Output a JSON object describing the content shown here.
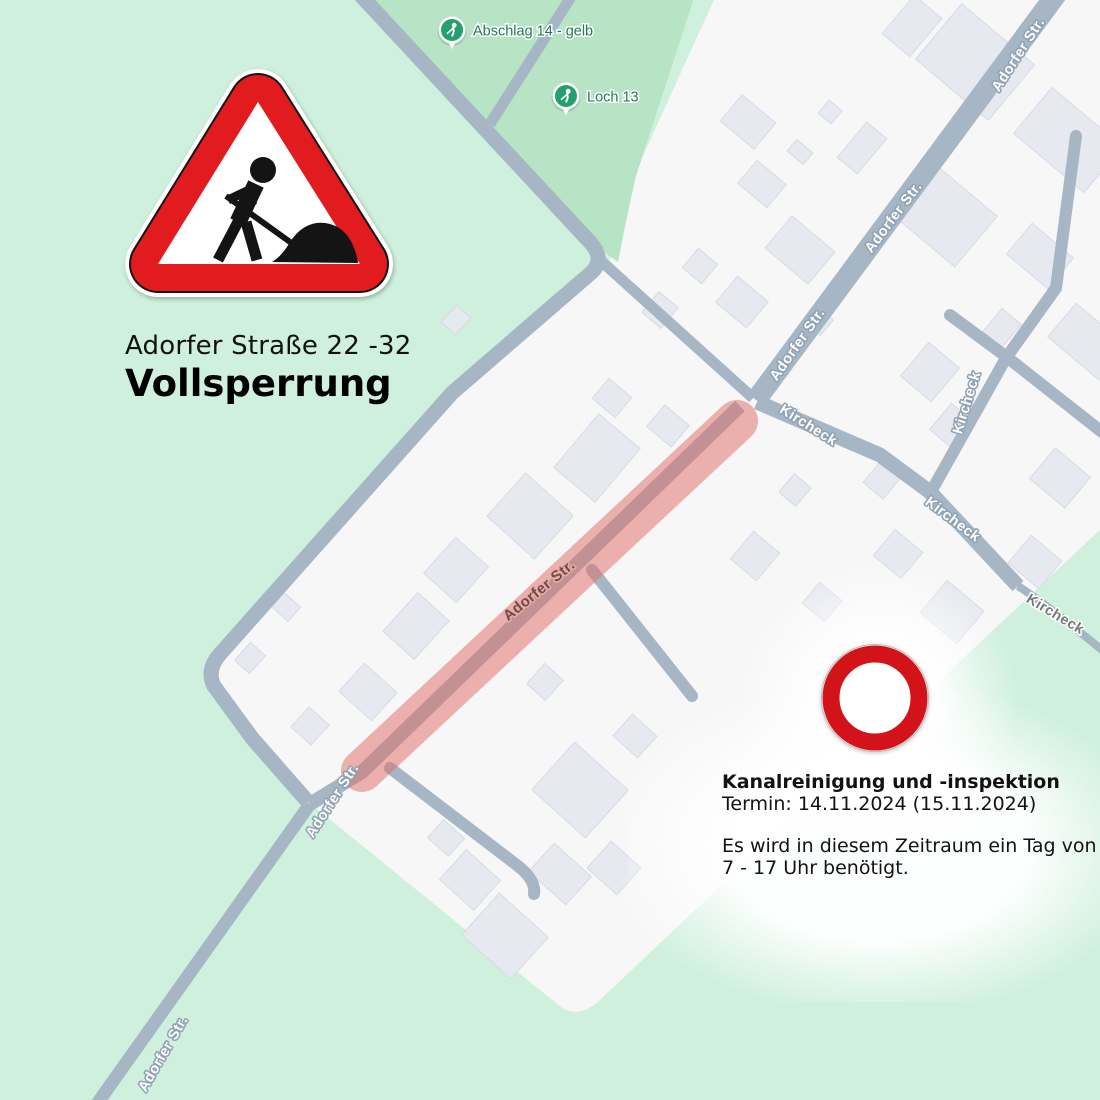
{
  "annotations": {
    "street_range": "Adorfer Straße 22 -32",
    "closure_type": "Vollsperrung",
    "info_title": "Kanalreinigung und -inspektion",
    "info_date": "Termin: 14.11.2024 (15.11.2024)",
    "info_body_1": "Es wird in diesem Zeitraum ein Tag von",
    "info_body_2": "7 - 17 Uhr benötigt."
  },
  "icons": {
    "roadworks": "roadworks-triangle-icon",
    "no_vehicles": "no-vehicles-circle-icon",
    "golf_marker": "golf-flag-marker-icon"
  },
  "signs": {
    "roadworks_red": "#e21b1f",
    "no_vehicles_red": "#d2141a"
  },
  "map": {
    "colors": {
      "meadow": "#cff0dd",
      "golf": "#b8e4c6",
      "urban": "#f7f7f8",
      "road": "#a6b6c5",
      "building": "#e6e9ef",
      "building_border": "#d6dbe4",
      "marker": "#23a06e",
      "marker_text": "#207a54",
      "closure": "#e06a62"
    },
    "regions": {
      "urban": "M723,-20 L632,180 Q620,228 612,256 L598,276 L452,393 L218,656 Q202,674 210,690 L306,800 L556,1003 Q576,1022 600,1000 C700,905 900,718 1104,526 L1104,-20 Z",
      "golf": "M352,-20 L588,238 L612,258 L618,262 Q626,220 636,176 L700,-20 Z"
    },
    "roads": [
      {
        "d": "M352,-14 L588,240 Q606,258 592,272 L452,393 L220,654 Q206,670 214,686 L252,738 L308,802",
        "w": 15
      },
      {
        "d": "M578,-14 L490,124",
        "w": 11
      },
      {
        "d": "M600,260 L753,398",
        "w": 11
      },
      {
        "d": "M1064,-16 L756,400",
        "w": 21
      },
      {
        "d": "M757,402 L880,455 L930,492 L1018,586",
        "w": 15
      },
      {
        "d": "M1018,586 Q1046,604 1102,650",
        "w": 8
      },
      {
        "d": "M1076,136 L1056,288 L1006,358 L932,490",
        "w": 12,
        "cap": "round"
      },
      {
        "d": "M950,315 L1008,358 L1102,432",
        "w": 12,
        "cap": "round"
      },
      {
        "d": "M740,406 L362,772 L310,804",
        "w": 14
      },
      {
        "d": "M310,804 L94,1108",
        "w": 13
      },
      {
        "d": "M390,768 L518,866 Q536,880 534,894",
        "w": 12,
        "cap": "round"
      },
      {
        "d": "M592,570 L692,696",
        "w": 12,
        "cap": "round"
      }
    ],
    "closure": {
      "x1": 737,
      "y1": 421,
      "x2": 362,
      "y2": 771,
      "width": 42,
      "color": "#e06a62",
      "opacity": 0.5
    },
    "buildings": [
      [
        975,
        62,
        72,
        95,
        -50
      ],
      [
        912,
        26,
        50,
        36,
        -50
      ],
      [
        1068,
        140,
        60,
        92,
        -50
      ],
      [
        943,
        214,
        66,
        86,
        -50
      ],
      [
        1040,
        256,
        40,
        54,
        -50
      ],
      [
        862,
        148,
        46,
        26,
        -50
      ],
      [
        830,
        112,
        17,
        17,
        -50
      ],
      [
        800,
        152,
        15,
        21,
        -50
      ],
      [
        1088,
        342,
        44,
        68,
        -50
      ],
      [
        1002,
        328,
        30,
        25,
        -50
      ],
      [
        930,
        372,
        44,
        40,
        -50
      ],
      [
        1060,
        478,
        40,
        46,
        -50
      ],
      [
        952,
        426,
        34,
        30,
        -50
      ],
      [
        1035,
        562,
        36,
        40,
        -50
      ],
      [
        898,
        554,
        34,
        36,
        -50
      ],
      [
        952,
        612,
        42,
        48,
        -50
      ],
      [
        882,
        480,
        28,
        26,
        -50
      ],
      [
        748,
        122,
        34,
        44,
        -50
      ],
      [
        762,
        184,
        30,
        38,
        -50
      ],
      [
        800,
        250,
        42,
        56,
        -50
      ],
      [
        742,
        302,
        34,
        40,
        -50
      ],
      [
        700,
        266,
        25,
        25,
        -50
      ],
      [
        820,
        322,
        20,
        18,
        -50
      ],
      [
        660,
        310,
        27,
        25,
        -50
      ],
      [
        668,
        426,
        28,
        32,
        -50
      ],
      [
        597,
        458,
        70,
        54,
        -50
      ],
      [
        612,
        398,
        26,
        30,
        -50
      ],
      [
        530,
        516,
        64,
        58,
        42
      ],
      [
        456,
        570,
        44,
        48,
        42
      ],
      [
        416,
        626,
        42,
        52,
        42
      ],
      [
        368,
        692,
        44,
        38,
        42
      ],
      [
        310,
        726,
        27,
        27,
        42
      ],
      [
        250,
        658,
        20,
        24,
        42
      ],
      [
        285,
        606,
        25,
        19,
        42
      ],
      [
        456,
        320,
        19,
        23,
        42
      ],
      [
        545,
        682,
        25,
        27,
        42
      ],
      [
        635,
        736,
        33,
        29,
        42
      ],
      [
        755,
        556,
        36,
        34,
        -50
      ],
      [
        822,
        602,
        27,
        29,
        -50
      ],
      [
        580,
        790,
        72,
        64,
        42
      ],
      [
        505,
        936,
        66,
        56,
        42
      ],
      [
        470,
        880,
        46,
        40,
        42
      ],
      [
        560,
        874,
        50,
        38,
        42
      ],
      [
        614,
        868,
        40,
        36,
        42
      ],
      [
        446,
        838,
        28,
        24,
        42
      ],
      [
        795,
        490,
        24,
        22,
        -50
      ]
    ],
    "street_labels": [
      {
        "text": "Adorfer Str.",
        "x": 1022,
        "y": 57,
        "rot": -57,
        "style": "white"
      },
      {
        "text": "Adorfer Str.",
        "x": 897,
        "y": 220,
        "rot": -53,
        "style": "white"
      },
      {
        "text": "Adorfer Str.",
        "x": 801,
        "y": 347,
        "rot": -55,
        "style": "white"
      },
      {
        "text": "Adorfer Str.",
        "x": 542,
        "y": 594,
        "rot": -39,
        "style": "closed",
        "size": 15
      },
      {
        "text": "Adorfer Str.",
        "x": 336,
        "y": 803,
        "rot": -57,
        "style": "white"
      },
      {
        "text": "Adorfer Str.",
        "x": 167,
        "y": 1056,
        "rot": -60,
        "style": "white"
      },
      {
        "text": "Kircheck",
        "x": 806,
        "y": 429,
        "rot": 32,
        "style": "white"
      },
      {
        "text": "Kircheck",
        "x": 950,
        "y": 523,
        "rot": 37,
        "style": "white"
      },
      {
        "text": "Kircheck",
        "x": 971,
        "y": 404,
        "rot": -73,
        "style": "white"
      },
      {
        "text": "Kircheck",
        "x": 1053,
        "y": 618,
        "rot": 31,
        "style": "green"
      }
    ],
    "markers": [
      {
        "label": "Abschlag 14 - gelb",
        "x": 452,
        "y": 30
      },
      {
        "label": "Loch 13",
        "x": 566,
        "y": 96
      }
    ]
  }
}
